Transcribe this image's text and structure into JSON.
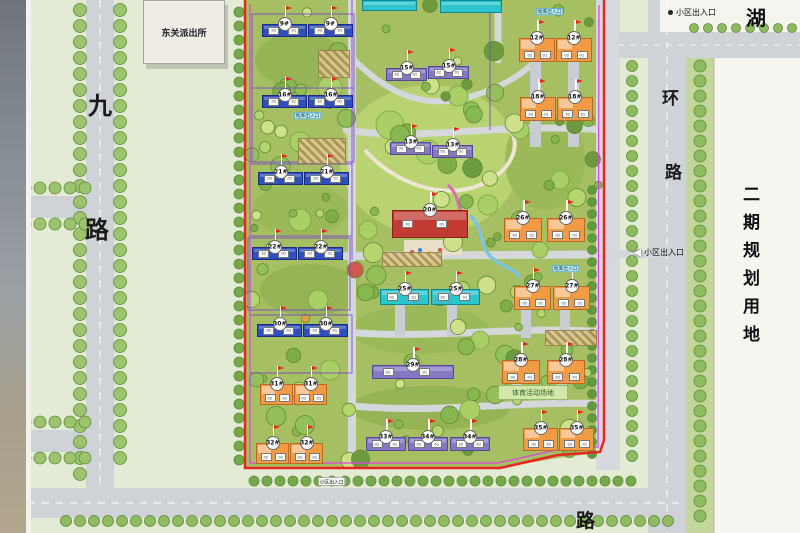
{
  "labels": {
    "police": "东关派出所",
    "lake": "湖",
    "road_left_top": "九",
    "road_left_bottom": "路",
    "road_right_top": "环",
    "road_right_mid": "路",
    "road_bottom": "路",
    "phase2": "二期规划用地",
    "sports": "体育活动场地",
    "garage": "地库出入口"
  },
  "entrances": {
    "top": "小区出入口",
    "right": "小区出入口",
    "bottom": "小区出入口"
  },
  "unit_labels": [
    "02",
    "01"
  ],
  "colors": {
    "blue": "#2f4fc0",
    "purple": "#8578c2",
    "teal": "#2ec4cd",
    "orange": "#f29b44",
    "red": "#c23b33",
    "boundary_red": "#e8251f",
    "boundary_magenta": "#e53ce5",
    "site_green": "#a6bf62",
    "road_grey": "#cfd3d8"
  },
  "buildings": [
    {
      "label": "9#",
      "type": "blue",
      "x": 262,
      "y": 24,
      "w": 45,
      "h": 13
    },
    {
      "label": "9#",
      "type": "blue",
      "x": 308,
      "y": 24,
      "w": 45,
      "h": 13
    },
    {
      "label": "16#",
      "type": "blue",
      "x": 262,
      "y": 95,
      "w": 45,
      "h": 13
    },
    {
      "label": "16#",
      "type": "blue",
      "x": 308,
      "y": 95,
      "w": 45,
      "h": 13
    },
    {
      "label": "21#",
      "type": "blue",
      "x": 258,
      "y": 172,
      "w": 45,
      "h": 13
    },
    {
      "label": "21#",
      "type": "blue",
      "x": 304,
      "y": 172,
      "w": 45,
      "h": 13
    },
    {
      "label": "22#",
      "type": "blue",
      "x": 252,
      "y": 247,
      "w": 45,
      "h": 13
    },
    {
      "label": "22#",
      "type": "blue",
      "x": 298,
      "y": 247,
      "w": 45,
      "h": 13
    },
    {
      "label": "30#",
      "type": "blue",
      "x": 257,
      "y": 324,
      "w": 45,
      "h": 13
    },
    {
      "label": "30#",
      "type": "blue",
      "x": 303,
      "y": 324,
      "w": 45,
      "h": 13
    },
    {
      "label": "31#",
      "type": "orange",
      "x": 260,
      "y": 384,
      "w": 33,
      "h": 21
    },
    {
      "label": "31#",
      "type": "orange",
      "x": 294,
      "y": 384,
      "w": 33,
      "h": 21
    },
    {
      "label": "32#",
      "type": "orange",
      "x": 256,
      "y": 443,
      "w": 33,
      "h": 21
    },
    {
      "label": "32#",
      "type": "orange",
      "x": 290,
      "y": 443,
      "w": 33,
      "h": 21
    },
    {
      "label": "15#",
      "type": "purple",
      "x": 386,
      "y": 68,
      "w": 41,
      "h": 13
    },
    {
      "label": "15#",
      "type": "purple",
      "x": 428,
      "y": 66,
      "w": 41,
      "h": 13
    },
    {
      "label": "13#",
      "type": "purple",
      "x": 390,
      "y": 142,
      "w": 41,
      "h": 13
    },
    {
      "label": "13#",
      "type": "purple",
      "x": 432,
      "y": 145,
      "w": 41,
      "h": 13
    },
    {
      "label": "20#",
      "type": "red",
      "x": 392,
      "y": 210,
      "w": 76,
      "h": 28
    },
    {
      "label": "25#",
      "type": "teal",
      "x": 380,
      "y": 289,
      "w": 49,
      "h": 16
    },
    {
      "label": "25#",
      "type": "teal",
      "x": 431,
      "y": 289,
      "w": 49,
      "h": 16
    },
    {
      "label": "29#",
      "type": "purple",
      "x": 372,
      "y": 365,
      "w": 82,
      "h": 14
    },
    {
      "label": "33#",
      "type": "purple",
      "x": 366,
      "y": 437,
      "w": 40,
      "h": 14
    },
    {
      "label": "34#",
      "type": "purple",
      "x": 408,
      "y": 437,
      "w": 40,
      "h": 14
    },
    {
      "label": "34#",
      "type": "purple",
      "x": 450,
      "y": 437,
      "w": 40,
      "h": 14
    },
    {
      "label": "12#",
      "type": "orange",
      "x": 519,
      "y": 38,
      "w": 36,
      "h": 24
    },
    {
      "label": "12#",
      "type": "orange",
      "x": 556,
      "y": 38,
      "w": 36,
      "h": 24
    },
    {
      "label": "18#",
      "type": "orange",
      "x": 520,
      "y": 97,
      "w": 36,
      "h": 24
    },
    {
      "label": "18#",
      "type": "orange",
      "x": 557,
      "y": 97,
      "w": 36,
      "h": 24
    },
    {
      "label": "26#",
      "type": "orange",
      "x": 504,
      "y": 218,
      "w": 38,
      "h": 24
    },
    {
      "label": "26#",
      "type": "orange",
      "x": 547,
      "y": 218,
      "w": 38,
      "h": 24
    },
    {
      "label": "27#",
      "type": "orange",
      "x": 514,
      "y": 286,
      "w": 37,
      "h": 24
    },
    {
      "label": "27#",
      "type": "orange",
      "x": 553,
      "y": 286,
      "w": 37,
      "h": 24
    },
    {
      "label": "28#",
      "type": "orange",
      "x": 502,
      "y": 360,
      "w": 38,
      "h": 24
    },
    {
      "label": "28#",
      "type": "orange",
      "x": 547,
      "y": 360,
      "w": 38,
      "h": 24
    },
    {
      "label": "35#",
      "type": "orange",
      "x": 523,
      "y": 428,
      "w": 35,
      "h": 23
    },
    {
      "label": "35#",
      "type": "orange",
      "x": 559,
      "y": 428,
      "w": 35,
      "h": 23
    },
    {
      "label": "",
      "type": "teal",
      "x": 362,
      "y": 0,
      "w": 55,
      "h": 11
    },
    {
      "label": "",
      "type": "teal",
      "x": 440,
      "y": 0,
      "w": 62,
      "h": 13
    }
  ]
}
